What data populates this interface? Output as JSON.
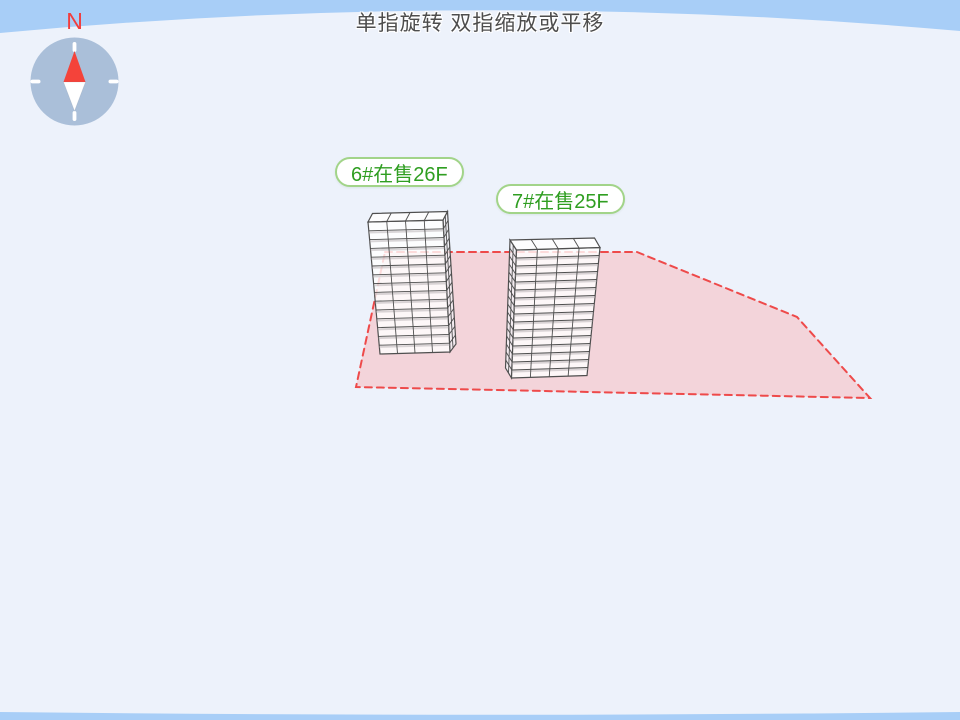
{
  "hint": {
    "text": "单指旋转 双指缩放或平移"
  },
  "compass": {
    "north_label": "N"
  },
  "buildings": [
    {
      "id": "6",
      "label": "6#在售26F",
      "floors": "26F",
      "status": "在售"
    },
    {
      "id": "7",
      "label": "7#在售25F",
      "floors": "25F",
      "status": "在售"
    }
  ],
  "colors": {
    "sky": "#a8cef7",
    "ground": "#edf2fb",
    "plot_fill": "#f3d4da",
    "plot_border": "#ee4a4a",
    "building_line": "#4f4f4f",
    "label_text": "#2f9e21",
    "label_border": "#a2d489",
    "compass_disc": "#aabfd9",
    "needle_north": "#f4433a",
    "needle_south": "#ffffff",
    "north_text": "#f23d3d",
    "hint_text": "#4d4d4d"
  }
}
